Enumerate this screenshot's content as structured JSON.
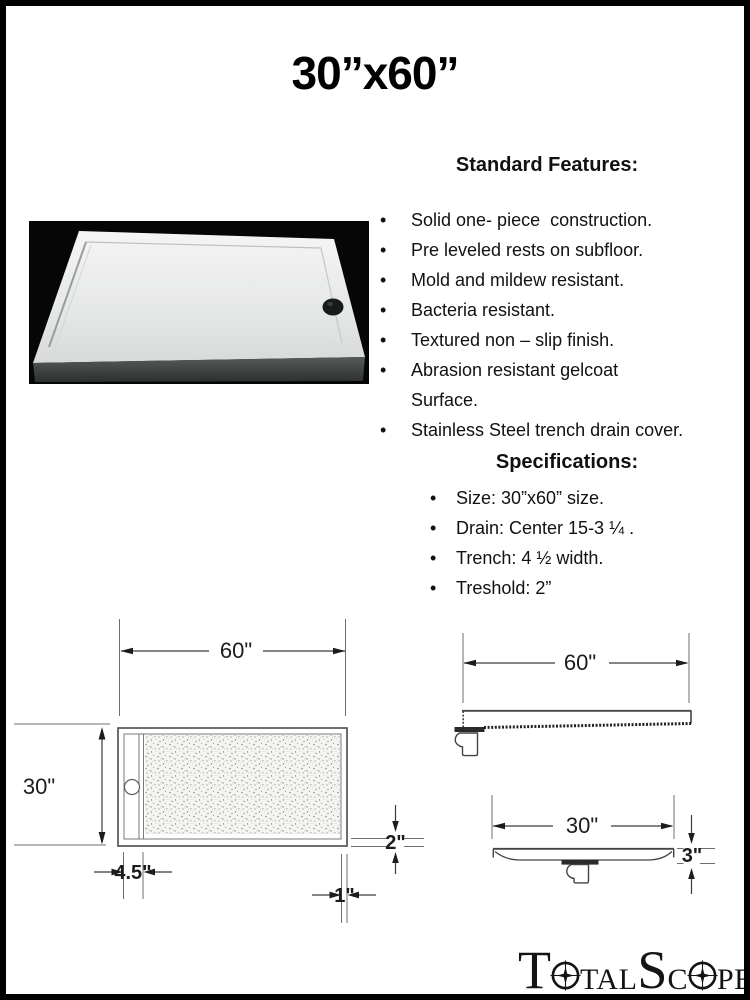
{
  "ui": {
    "bullet": "•"
  },
  "title": "30”x60”",
  "features": {
    "heading": "Standard Features:",
    "items": [
      "Solid one- piece  construction.",
      "Pre leveled rests on subfloor.",
      "Mold and mildew resistant.",
      "Bacteria resistant.",
      "Textured non – slip finish.",
      "Abrasion resistant gelcoat\nSurface.",
      "Stainless Steel trench drain cover."
    ]
  },
  "specifications": {
    "heading": "Specifications:",
    "items": [
      "Size: 30”x60” size.",
      "Drain: Center 15-3 ¼ .",
      "Trench: 4 ½ width.",
      "Treshold: 2”"
    ]
  },
  "drawings": {
    "top_view": {
      "width_label": "60\"",
      "height_label": "30\"",
      "trench_offset_label": "4.5\"",
      "edge_label": "1\"",
      "threshold_label": "2\""
    },
    "side_view": {
      "length_label": "60\""
    },
    "front_view": {
      "width_label": "30\"",
      "height_label": "3\""
    }
  },
  "logo": {
    "text": "TotalScope",
    "seg1": "T",
    "seg2": "TAL",
    "seg3": "S",
    "seg4": "C",
    "seg5": "PE"
  }
}
